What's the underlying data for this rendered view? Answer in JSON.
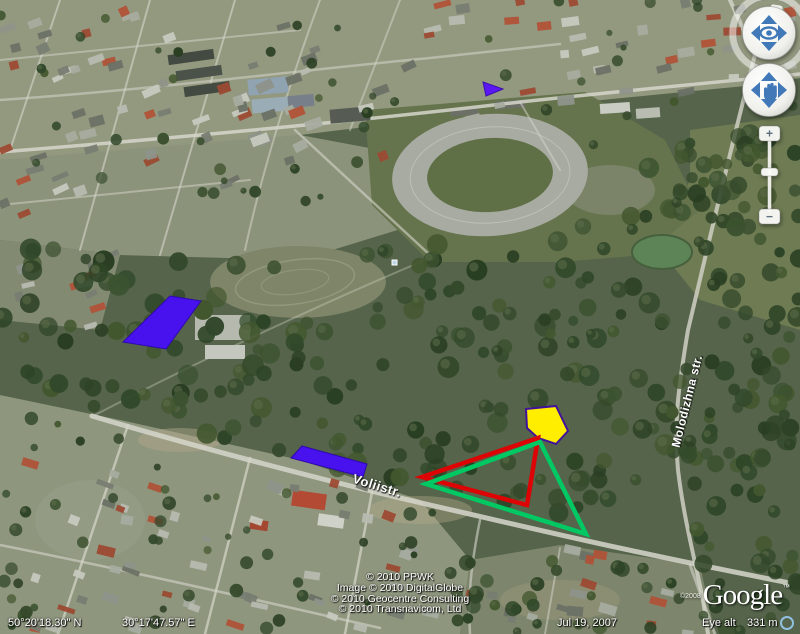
{
  "nav_controls": {
    "north_label": "N",
    "zoom_in_label": "+",
    "zoom_out_label": "−"
  },
  "street_labels": [
    {
      "text": "Voliistr."
    },
    {
      "text": "Molodizhna str."
    }
  ],
  "copyright": {
    "lines": [
      "© 2010 PPWK",
      "Image © 2010 DigitalGlobe",
      "© 2010 Geocentre Consulting",
      "© 2010 Transnavicom, Ltd"
    ],
    "logo_year": "©2008",
    "logo_text": "Google",
    "logo_tm": "™"
  },
  "status_bar": {
    "latitude": "50°20'18.30\" N",
    "longitude": "30°17'47.57\" E",
    "imagery_date": "Jul 19, 2007",
    "eye_alt_label": "Eye alt",
    "eye_alt_value": "331 m"
  },
  "overlays": {
    "shapes": [
      {
        "name": "blue-parallelogram-large",
        "type": "polygon",
        "fill": "#4812ee",
        "stroke": "#2f09ad",
        "stroke_width": 1,
        "points": [
          [
            170,
            296
          ],
          [
            201,
            301
          ],
          [
            166,
            349
          ],
          [
            123,
            342
          ]
        ]
      },
      {
        "name": "blue-parallelogram-small",
        "type": "polygon",
        "fill": "#4812ee",
        "stroke": "#2f09ad",
        "stroke_width": 1,
        "points": [
          [
            302,
            446
          ],
          [
            367,
            464
          ],
          [
            363,
            477
          ],
          [
            291,
            458
          ]
        ]
      },
      {
        "name": "blue-triangle-small",
        "type": "polygon",
        "fill": "#5a17f2",
        "stroke": "#3a0fb0",
        "stroke_width": 1,
        "points": [
          [
            483,
            82
          ],
          [
            503,
            89
          ],
          [
            486,
            96
          ]
        ]
      },
      {
        "name": "yellow-pentagon",
        "type": "polygon",
        "fill": "#ffee00",
        "stroke": "#40129b",
        "stroke_width": 2,
        "points": [
          [
            526,
            409
          ],
          [
            556,
            406
          ],
          [
            568,
            431
          ],
          [
            556,
            444
          ],
          [
            538,
            438
          ],
          [
            527,
            428
          ]
        ]
      },
      {
        "name": "red-triangle",
        "type": "outline",
        "stroke": "#dc0404",
        "stroke_width": 4.5,
        "points": [
          [
            538,
            438
          ],
          [
            422,
            477
          ],
          [
            527,
            505
          ]
        ]
      },
      {
        "name": "green-triangle",
        "type": "outline",
        "stroke": "#00c964",
        "stroke_width": 4.5,
        "points": [
          [
            540,
            442
          ],
          [
            426,
            484
          ],
          [
            586,
            534
          ]
        ]
      }
    ]
  }
}
